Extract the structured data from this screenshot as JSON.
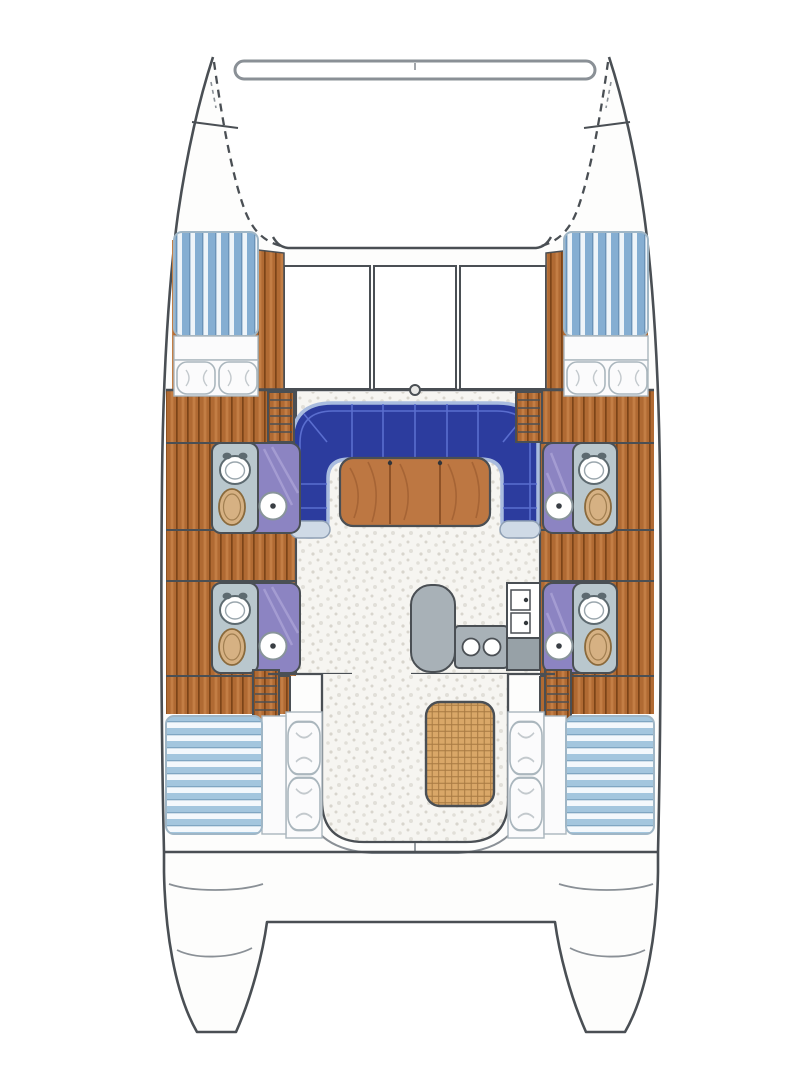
{
  "diagram": {
    "kind": "catamaran-deck-plan",
    "orientation": "bow-up",
    "layout_summary": {
      "double_berths": 4,
      "heads_with_shower": 4,
      "salon_settee": 1,
      "salon_table_sections": 3,
      "galley_sinks": 2,
      "galley_burners": 2,
      "cockpit_table": 1,
      "companionway_steps": 4,
      "foredeck_hatches": 3
    },
    "regions": [
      "port-bow",
      "starboard-bow",
      "bow-crossbeam",
      "trampoline",
      "foredeck",
      "port-forward-cabin",
      "starboard-forward-cabin",
      "port-forward-head",
      "port-aft-head",
      "starboard-forward-head",
      "starboard-aft-head",
      "salon",
      "salon-settee",
      "salon-table",
      "galley",
      "mast-step",
      "cockpit",
      "cockpit-table",
      "port-aft-cabin",
      "starboard-aft-cabin",
      "port-transom",
      "starboard-transom",
      "aft-crossbeam"
    ]
  },
  "colors": {
    "outline": "#4a4f54",
    "outline_soft": "#8a9096",
    "hull": "#fdfdfc",
    "white": "#ffffff",
    "wood": "#b06a33",
    "wood_dark": "#7c4418",
    "wood_light": "#d query2",
    "speckle_bg": "#f6f5f1",
    "speckle_dot": "#e1dfd8",
    "speckle_dot2": "#d8d5cd",
    "berth_bg": "#eef4f9",
    "berth_stripe": "#85aed2",
    "berth_stripe_dark": "#6b93b8",
    "aft_berth_bg": "#f3f8fc",
    "aft_berth_stripe": "#a3c6de",
    "aft_berth_stripe_dark": "#7fa6c2",
    "berth_edge": "#9fb6c6",
    "linen": "#fbfbfc",
    "linen_edge": "#aab6bd",
    "pillow_line": "#c3c9cd",
    "settee": "#2c3c9e",
    "settee_seam": "#5a6ecf",
    "settee_edge": "#a9bcdf",
    "settee_cap": "#cfdae6",
    "settee_cap_edge": "#8fa0b4",
    "table": "#bd7742",
    "table_seam": "#8f5227",
    "table_dot": "#30353a",
    "head_floor": "#8c84c2",
    "head_floor_light": "#aaa3d6",
    "fixture": "#b9c7cd",
    "fixture_edge": "#5d6a70",
    "sink": "#d6b183",
    "sink_edge": "#8a6a3c",
    "galley": "#a8b1b7",
    "galley_dark": "#97a1a7",
    "wicker": "#d9a768",
    "wicker_line": "#a87a42",
    "mast_fill": "#e8e8e6",
    "drain_dot": "#3a3f44",
    "burner_dot": "#33383c"
  }
}
